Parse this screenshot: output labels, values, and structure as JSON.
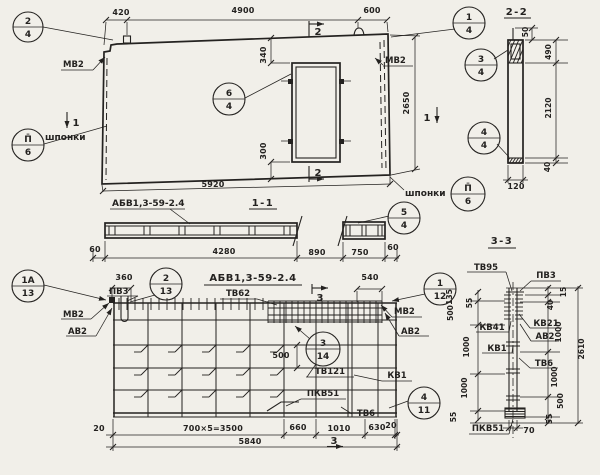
{
  "palette": {
    "paper": "#f1efe9",
    "ink": "#242220"
  },
  "plan": {
    "d420": "420",
    "d4900": "4900",
    "d600": "600",
    "d5920": "5920",
    "d2650": "2650",
    "d340": "340",
    "d300": "300",
    "mv2_left": "МВ2",
    "mv2_right": "МВ2",
    "shponki_left": "шпонки",
    "shponki_right": "шпонки",
    "sec1_left": "1",
    "sec1_right": "1",
    "sec2_top": "2",
    "sec2_bottom": "2",
    "c24_num": "2",
    "c24_den": "4",
    "c64_num": "6",
    "c64_den": "4",
    "c14_num": "1",
    "c14_den": "4",
    "cp6l_num": "П̄",
    "cp6l_den": "6",
    "cp6r_num": "П̄",
    "cp6r_den": "6"
  },
  "s22": {
    "title": "2-2",
    "d50": "50",
    "d490": "490",
    "d2120": "2120",
    "d40": "40",
    "d120": "120",
    "c34_num": "3",
    "c34_den": "4",
    "c44_num": "4",
    "c44_den": "4"
  },
  "s11": {
    "title": "1-1",
    "label": "АБВ1,3-59-2.4",
    "d60l": "60",
    "d4280": "4280",
    "d890": "890",
    "d750": "750",
    "d60r": "60",
    "c54_num": "5",
    "c54_den": "4"
  },
  "reinf": {
    "title": "АБВ1,3-59-2.4",
    "tv62": "ТВ62",
    "d360": "360",
    "d540": "540",
    "d500": "500",
    "pv3": "ПВ3",
    "mv2_left": "МВ2",
    "av2_left": "АВ2",
    "mv2_right": "МВ2",
    "av2_right": "АВ2",
    "tv121": "ТВ121",
    "kv1": "КВ1",
    "pkv51": "ПКВ51",
    "tv6": "ТВ6",
    "sec3_top": "3",
    "sec3_bottom": "3",
    "d20l": "20",
    "d3500": "700×5=3500",
    "d660": "660",
    "d1010": "1010",
    "d630": "630",
    "d20r": "20",
    "d5840": "5840",
    "c1a13_num": "1А",
    "c1a13_den": "13",
    "c213_num": "2",
    "c213_den": "13",
    "c112_num": "1",
    "c112_den": "12",
    "c314_num": "3",
    "c314_den": "14",
    "c411_num": "4",
    "c411_den": "11"
  },
  "s33": {
    "title": "3-3",
    "tv95": "ТВ95",
    "pv3": "ПВ3",
    "kv41": "КВ41",
    "kv21": "КВ21",
    "av2": "АВ2",
    "kv1": "КВ1",
    "tv6": "ТВ6",
    "pkv51": "ПКВ51",
    "dl135": "135",
    "dl55t": "55",
    "dl500": "500",
    "dl1000a": "1000",
    "dl1000b": "1000",
    "dl55b": "55",
    "dr15": "15",
    "dr40": "40",
    "dr1000a": "1000",
    "dr1000b": "1000",
    "dr500": "500",
    "dr55": "55",
    "d2610": "2610",
    "d70": "70"
  }
}
